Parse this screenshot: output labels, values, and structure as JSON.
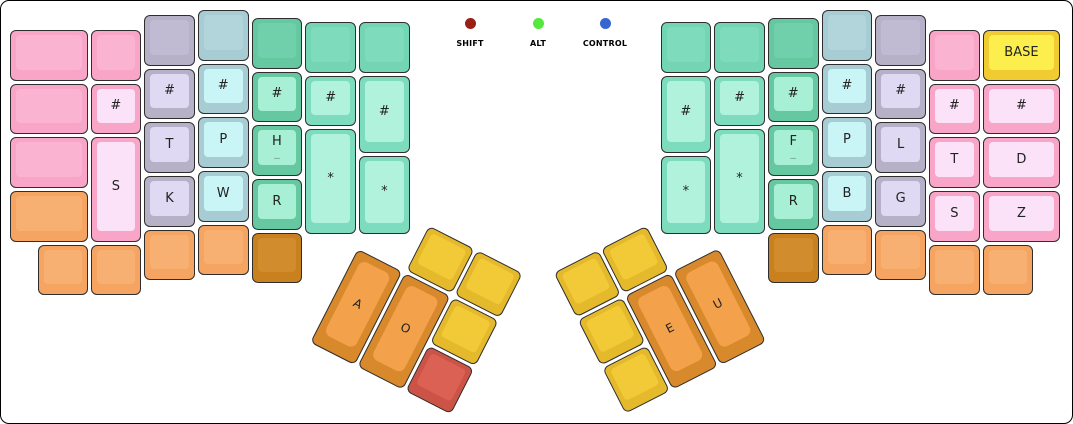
{
  "canvas": {
    "width": 1073,
    "height": 424,
    "background": "#ffffff",
    "border_color": "#000000"
  },
  "legend": {
    "dot_center_y": 17,
    "label_y": 41,
    "items": [
      {
        "label": "SHIFT",
        "color": "#9A2015",
        "x": 469
      },
      {
        "label": "ALT",
        "color": "#55E83E",
        "x": 537
      },
      {
        "label": "CONTROL",
        "color": "#3566D2",
        "x": 604
      }
    ]
  },
  "palette": {
    "pink": {
      "outer": "#F8A5C7",
      "inner": "#FAB3D0"
    },
    "pinkLight": {
      "outer": "#F8A5C7",
      "inner": "#FBE2F8"
    },
    "lav": {
      "outer": "#B7B1C8",
      "inner": "#C0BAD2"
    },
    "lavLight": {
      "outer": "#B7B1C8",
      "inner": "#DFD9F3"
    },
    "blue": {
      "outer": "#A7CCD4",
      "inner": "#B2D5DC"
    },
    "blueLight": {
      "outer": "#A7CCD4",
      "inner": "#CAF5F7"
    },
    "green": {
      "outer": "#65C8A1",
      "inner": "#70D0AB"
    },
    "greenLight": {
      "outer": "#65C8A1",
      "inner": "#A8F0D5"
    },
    "mintBlank": {
      "outer": "#74D5B4",
      "inner": "#7EDBBB"
    },
    "mint": {
      "outer": "#7EDCBE",
      "inner": "#B1F2DC"
    },
    "orange": {
      "outer": "#F5A462",
      "inner": "#F8B072"
    },
    "dkorange": {
      "outer": "#C8811E",
      "inner": "#D18C2E"
    },
    "yellow": {
      "outer": "#E4BA2C",
      "inner": "#F2C936"
    },
    "red": {
      "outer": "#CC5447",
      "inner": "#DA6154"
    },
    "thumb": {
      "outer": "#D8892B",
      "inner": "#F3A24B"
    },
    "base": {
      "outer": "#F0CC32",
      "inner": "#FCEF4D"
    }
  },
  "clusters": {
    "left": {
      "x": 379.7,
      "y": 197.8,
      "rotation": 27
    },
    "right": {
      "x": 549.8,
      "y": 270.9,
      "rotation": -27
    }
  },
  "keys": [
    {
      "name": "key-blank",
      "x": 9,
      "y": 29,
      "w": 77.5,
      "h": 50.7,
      "color": "pink",
      "label": ""
    },
    {
      "name": "key-blank",
      "x": 9,
      "y": 82.7,
      "w": 77.5,
      "h": 50.7,
      "color": "pink",
      "label": ""
    },
    {
      "name": "key-blank",
      "x": 9,
      "y": 136.4,
      "w": 77.5,
      "h": 50.7,
      "color": "pink",
      "label": ""
    },
    {
      "name": "key-blank",
      "x": 9,
      "y": 190.1,
      "w": 77.5,
      "h": 50.7,
      "color": "orange",
      "label": ""
    },
    {
      "name": "key-blank",
      "x": 36.8,
      "y": 243.8,
      "w": 50.7,
      "h": 50.7,
      "color": "orange",
      "label": ""
    },
    {
      "name": "key-blank",
      "x": 89.5,
      "y": 29,
      "w": 50.7,
      "h": 50.7,
      "color": "pink",
      "label": ""
    },
    {
      "name": "key-hash",
      "x": 89.5,
      "y": 82.7,
      "w": 50.7,
      "h": 50.7,
      "color": "pinkLight",
      "label": "#"
    },
    {
      "name": "key-s",
      "x": 89.5,
      "y": 136.4,
      "w": 50.7,
      "h": 104.4,
      "color": "pinkLight",
      "label": "S"
    },
    {
      "name": "key-blank",
      "x": 89.5,
      "y": 243.8,
      "w": 50.7,
      "h": 50.7,
      "color": "orange",
      "label": ""
    },
    {
      "name": "key-blank",
      "x": 143.2,
      "y": 14,
      "w": 50.7,
      "h": 50.7,
      "color": "lav",
      "label": ""
    },
    {
      "name": "key-hash",
      "x": 143.2,
      "y": 67.7,
      "w": 50.7,
      "h": 50.7,
      "color": "lavLight",
      "label": "#"
    },
    {
      "name": "key-t",
      "x": 143.2,
      "y": 121.4,
      "w": 50.7,
      "h": 50.7,
      "color": "lavLight",
      "label": "T"
    },
    {
      "name": "key-k",
      "x": 143.2,
      "y": 175.1,
      "w": 50.7,
      "h": 50.7,
      "color": "lavLight",
      "label": "K"
    },
    {
      "name": "key-blank",
      "x": 143.2,
      "y": 228.8,
      "w": 50.7,
      "h": 50.7,
      "color": "orange",
      "label": ""
    },
    {
      "name": "key-blank",
      "x": 196.9,
      "y": 9,
      "w": 50.7,
      "h": 50.7,
      "color": "blue",
      "label": ""
    },
    {
      "name": "key-hash",
      "x": 196.9,
      "y": 62.7,
      "w": 50.7,
      "h": 50.7,
      "color": "blueLight",
      "label": "#"
    },
    {
      "name": "key-p",
      "x": 196.9,
      "y": 116.4,
      "w": 50.7,
      "h": 50.7,
      "color": "blueLight",
      "label": "P"
    },
    {
      "name": "key-w",
      "x": 196.9,
      "y": 170.1,
      "w": 50.7,
      "h": 50.7,
      "color": "blueLight",
      "label": "W"
    },
    {
      "name": "key-blank",
      "x": 196.9,
      "y": 223.8,
      "w": 50.7,
      "h": 50.7,
      "color": "orange",
      "label": ""
    },
    {
      "name": "key-blank",
      "x": 250.6,
      "y": 17,
      "w": 50.7,
      "h": 50.7,
      "color": "green",
      "label": ""
    },
    {
      "name": "key-hash",
      "x": 250.6,
      "y": 70.7,
      "w": 50.7,
      "h": 50.7,
      "color": "greenLight",
      "label": "#"
    },
    {
      "name": "key-h",
      "x": 250.6,
      "y": 124.4,
      "w": 50.7,
      "h": 50.7,
      "color": "greenLight",
      "label": "H",
      "sub": "_"
    },
    {
      "name": "key-r",
      "x": 250.6,
      "y": 178.1,
      "w": 50.7,
      "h": 50.7,
      "color": "greenLight",
      "label": "R"
    },
    {
      "name": "key-blank",
      "x": 250.6,
      "y": 231.8,
      "w": 50.7,
      "h": 50.7,
      "color": "dkorange",
      "label": ""
    },
    {
      "name": "key-blank",
      "x": 304.3,
      "y": 21,
      "w": 50.7,
      "h": 50.7,
      "color": "mintBlank",
      "label": ""
    },
    {
      "name": "key-hash",
      "x": 304.3,
      "y": 74.7,
      "w": 50.7,
      "h": 50.7,
      "color": "mint",
      "label": "#"
    },
    {
      "name": "key-star",
      "x": 304.3,
      "y": 128.4,
      "w": 50.7,
      "h": 104.4,
      "color": "mint",
      "label": "*"
    },
    {
      "name": "key-blank",
      "x": 358,
      "y": 21,
      "w": 50.7,
      "h": 50.7,
      "color": "mintBlank",
      "label": ""
    },
    {
      "name": "key-hash",
      "x": 358,
      "y": 74.7,
      "w": 50.7,
      "h": 77.5,
      "color": "mint",
      "label": "#"
    },
    {
      "name": "key-star",
      "x": 358,
      "y": 155.2,
      "w": 50.7,
      "h": 77.5,
      "color": "mint",
      "label": "*"
    },
    {
      "name": "key-blank",
      "x": 659.5,
      "y": 21,
      "w": 50.7,
      "h": 50.7,
      "color": "mintBlank",
      "label": ""
    },
    {
      "name": "key-hash",
      "x": 659.5,
      "y": 74.7,
      "w": 50.7,
      "h": 77.5,
      "color": "mint",
      "label": "#"
    },
    {
      "name": "key-star",
      "x": 659.5,
      "y": 155.2,
      "w": 50.7,
      "h": 77.5,
      "color": "mint",
      "label": "*"
    },
    {
      "name": "key-blank",
      "x": 713.2,
      "y": 21,
      "w": 50.7,
      "h": 50.7,
      "color": "mintBlank",
      "label": ""
    },
    {
      "name": "key-hash",
      "x": 713.2,
      "y": 74.7,
      "w": 50.7,
      "h": 50.7,
      "color": "mint",
      "label": "#"
    },
    {
      "name": "key-star",
      "x": 713.2,
      "y": 128.4,
      "w": 50.7,
      "h": 104.4,
      "color": "mint",
      "label": "*"
    },
    {
      "name": "key-blank",
      "x": 766.9,
      "y": 17,
      "w": 50.7,
      "h": 50.7,
      "color": "green",
      "label": ""
    },
    {
      "name": "key-hash",
      "x": 766.9,
      "y": 70.7,
      "w": 50.7,
      "h": 50.7,
      "color": "greenLight",
      "label": "#"
    },
    {
      "name": "key-f",
      "x": 766.9,
      "y": 124.4,
      "w": 50.7,
      "h": 50.7,
      "color": "greenLight",
      "label": "F",
      "sub": "_"
    },
    {
      "name": "key-r",
      "x": 766.9,
      "y": 178.1,
      "w": 50.7,
      "h": 50.7,
      "color": "greenLight",
      "label": "R"
    },
    {
      "name": "key-blank",
      "x": 766.9,
      "y": 231.8,
      "w": 50.7,
      "h": 50.7,
      "color": "dkorange",
      "label": ""
    },
    {
      "name": "key-blank",
      "x": 820.6,
      "y": 9,
      "w": 50.7,
      "h": 50.7,
      "color": "blue",
      "label": ""
    },
    {
      "name": "key-hash",
      "x": 820.6,
      "y": 62.7,
      "w": 50.7,
      "h": 50.7,
      "color": "blueLight",
      "label": "#"
    },
    {
      "name": "key-p",
      "x": 820.6,
      "y": 116.4,
      "w": 50.7,
      "h": 50.7,
      "color": "blueLight",
      "label": "P"
    },
    {
      "name": "key-b",
      "x": 820.6,
      "y": 170.1,
      "w": 50.7,
      "h": 50.7,
      "color": "blueLight",
      "label": "B"
    },
    {
      "name": "key-blank",
      "x": 820.6,
      "y": 223.8,
      "w": 50.7,
      "h": 50.7,
      "color": "orange",
      "label": ""
    },
    {
      "name": "key-blank",
      "x": 874.3,
      "y": 14,
      "w": 50.7,
      "h": 50.7,
      "color": "lav",
      "label": ""
    },
    {
      "name": "key-hash",
      "x": 874.3,
      "y": 67.7,
      "w": 50.7,
      "h": 50.7,
      "color": "lavLight",
      "label": "#"
    },
    {
      "name": "key-l",
      "x": 874.3,
      "y": 121.4,
      "w": 50.7,
      "h": 50.7,
      "color": "lavLight",
      "label": "L"
    },
    {
      "name": "key-g",
      "x": 874.3,
      "y": 175.1,
      "w": 50.7,
      "h": 50.7,
      "color": "lavLight",
      "label": "G"
    },
    {
      "name": "key-blank",
      "x": 874.3,
      "y": 228.8,
      "w": 50.7,
      "h": 50.7,
      "color": "orange",
      "label": ""
    },
    {
      "name": "key-blank",
      "x": 928,
      "y": 29,
      "w": 50.7,
      "h": 50.7,
      "color": "pink",
      "label": ""
    },
    {
      "name": "key-hash",
      "x": 928,
      "y": 82.7,
      "w": 50.7,
      "h": 50.7,
      "color": "pinkLight",
      "label": "#"
    },
    {
      "name": "key-t",
      "x": 928,
      "y": 136.4,
      "w": 50.7,
      "h": 50.7,
      "color": "pinkLight",
      "label": "T"
    },
    {
      "name": "key-s",
      "x": 928,
      "y": 190.1,
      "w": 50.7,
      "h": 50.7,
      "color": "pinkLight",
      "label": "S"
    },
    {
      "name": "key-blank",
      "x": 928,
      "y": 243.8,
      "w": 50.7,
      "h": 50.7,
      "color": "orange",
      "label": ""
    },
    {
      "name": "key-base",
      "x": 981.7,
      "y": 29,
      "w": 77.5,
      "h": 50.7,
      "color": "base",
      "label": "BASE"
    },
    {
      "name": "key-hash",
      "x": 981.7,
      "y": 82.7,
      "w": 77.5,
      "h": 50.7,
      "color": "pinkLight",
      "label": "#"
    },
    {
      "name": "key-d",
      "x": 981.7,
      "y": 136.4,
      "w": 77.5,
      "h": 50.7,
      "color": "pinkLight",
      "label": "D"
    },
    {
      "name": "key-z",
      "x": 981.7,
      "y": 190.1,
      "w": 77.5,
      "h": 50.7,
      "color": "pinkLight",
      "label": "Z"
    },
    {
      "name": "key-blank",
      "x": 981.7,
      "y": 243.8,
      "w": 50.7,
      "h": 50.7,
      "color": "orange",
      "label": ""
    }
  ],
  "cluster_keys": [
    {
      "cluster": "left",
      "name": "key-blank",
      "x": 55.2,
      "y": 1.5,
      "w": 50.7,
      "h": 50.7,
      "color": "yellow",
      "label": ""
    },
    {
      "cluster": "left",
      "name": "key-blank",
      "x": 108.9,
      "y": 1.5,
      "w": 50.7,
      "h": 50.7,
      "color": "yellow",
      "label": ""
    },
    {
      "cluster": "left",
      "name": "key-a",
      "x": 1.5,
      "y": 55.2,
      "w": 50.7,
      "h": 104.4,
      "color": "thumb",
      "label": "A",
      "big": true
    },
    {
      "cluster": "left",
      "name": "key-o",
      "x": 55.2,
      "y": 55.2,
      "w": 50.7,
      "h": 104.4,
      "color": "thumb",
      "label": "O",
      "big": true
    },
    {
      "cluster": "left",
      "name": "key-blank",
      "x": 108.9,
      "y": 55.2,
      "w": 50.7,
      "h": 50.7,
      "color": "yellow",
      "label": ""
    },
    {
      "cluster": "left",
      "name": "key-blank",
      "x": 108.9,
      "y": 108.9,
      "w": 50.7,
      "h": 50.7,
      "color": "red",
      "label": ""
    },
    {
      "cluster": "right",
      "name": "key-blank",
      "x": 1.5,
      "y": 1.5,
      "w": 50.7,
      "h": 50.7,
      "color": "yellow",
      "label": ""
    },
    {
      "cluster": "right",
      "name": "key-blank",
      "x": 55.2,
      "y": 1.5,
      "w": 50.7,
      "h": 50.7,
      "color": "yellow",
      "label": ""
    },
    {
      "cluster": "right",
      "name": "key-blank",
      "x": 1.5,
      "y": 55.2,
      "w": 50.7,
      "h": 50.7,
      "color": "yellow",
      "label": ""
    },
    {
      "cluster": "right",
      "name": "key-blank",
      "x": 1.5,
      "y": 108.9,
      "w": 50.7,
      "h": 50.7,
      "color": "yellow",
      "label": ""
    },
    {
      "cluster": "right",
      "name": "key-e",
      "x": 55.2,
      "y": 55.2,
      "w": 50.7,
      "h": 104.4,
      "color": "thumb",
      "label": "E",
      "big": true
    },
    {
      "cluster": "right",
      "name": "key-u",
      "x": 108.9,
      "y": 55.2,
      "w": 50.7,
      "h": 104.4,
      "color": "thumb",
      "label": "U",
      "big": true
    }
  ]
}
